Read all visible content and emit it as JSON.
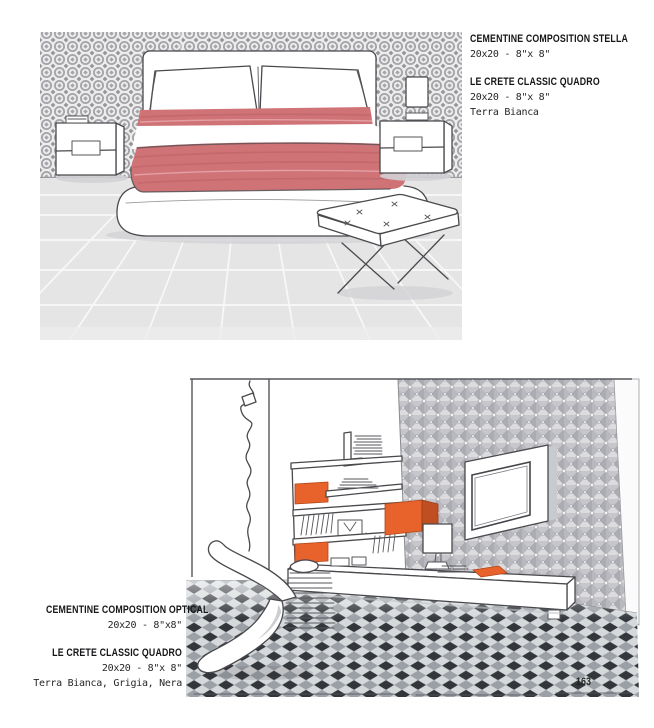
{
  "page": {
    "number": "163"
  },
  "caption_bedroom": {
    "product1_name": "CEMENTINE COMPOSITION STELLA",
    "product1_size": "20x20 - 8\"x 8\"",
    "product2_name": "LE CRETE CLASSIC QUADRO",
    "product2_size": "20x20 - 8\"x 8\"",
    "product2_finish": "Terra Bianca"
  },
  "caption_livingroom": {
    "product1_name": "CEMENTINE COMPOSITION OPTICAL",
    "product1_size": "20x20 - 8\"x8\"",
    "product2_name": "LE CRETE CLASSIC QUADRO",
    "product2_size": "20x20 - 8\"x 8\"",
    "product2_finish": "Terra Bianca, Grigia, Nera"
  },
  "colors": {
    "blanket_red": "#cf7377",
    "accent_orange": "#e8622b",
    "pattern_gray": "#a6a6aa",
    "floor_dark": "#33363b",
    "floor_mid": "#9aa0a6",
    "floor_light": "#d6d9db"
  }
}
